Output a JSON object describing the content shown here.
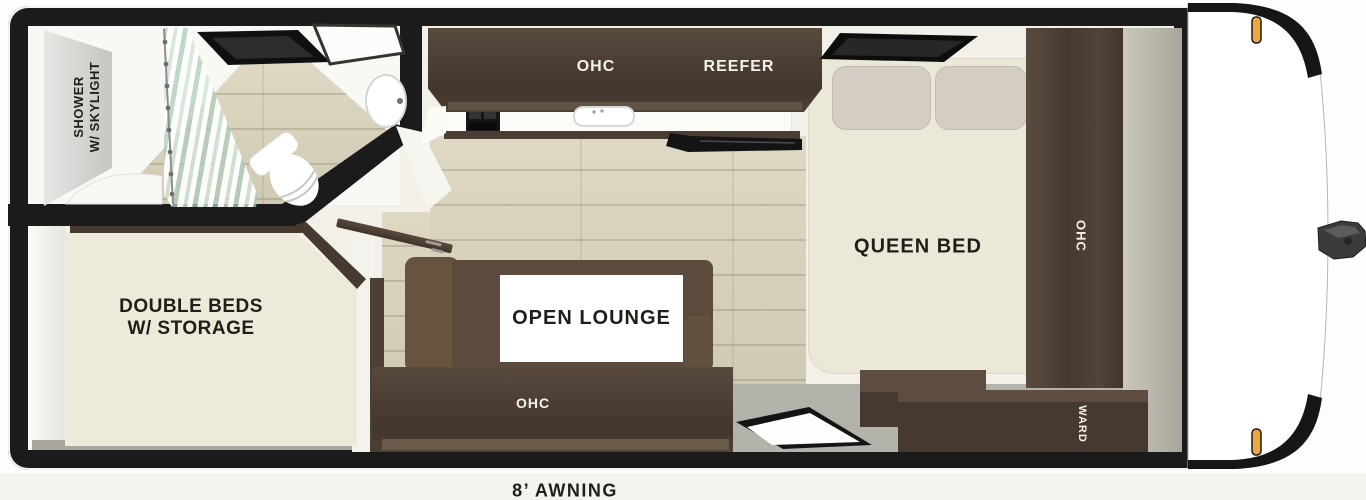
{
  "floorplan": {
    "awning_label": "8’ AWNING",
    "bathroom": {
      "label_line1": "SHOWER",
      "label_line2": "W/ SKYLIGHT"
    },
    "rear_bedroom": {
      "label_line1": "DOUBLE BEDS",
      "label_line2": "W/ STORAGE"
    },
    "lounge": {
      "label": "OPEN LOUNGE"
    },
    "front_bedroom": {
      "label": "QUEEN BED"
    },
    "cabinets": {
      "kitchen_overhead": "OHC",
      "refrigerator": "REEFER",
      "lounge_overhead": "OHC",
      "wardrobe_tall": "OHC",
      "wardrobe_front": "WARD"
    },
    "colors": {
      "wall_black": "#1b1b1b",
      "cabinet_dark_wood": "#4a3d33",
      "floor_wood": "#d8d2bd",
      "bed_cream": "#ece8d7",
      "sofa_brown": "#5c4b3d",
      "walkway_gray": "#b4b3ab",
      "front_wall_gray": "#b3b0a6",
      "marker_light_amber": "#eca73e"
    }
  }
}
